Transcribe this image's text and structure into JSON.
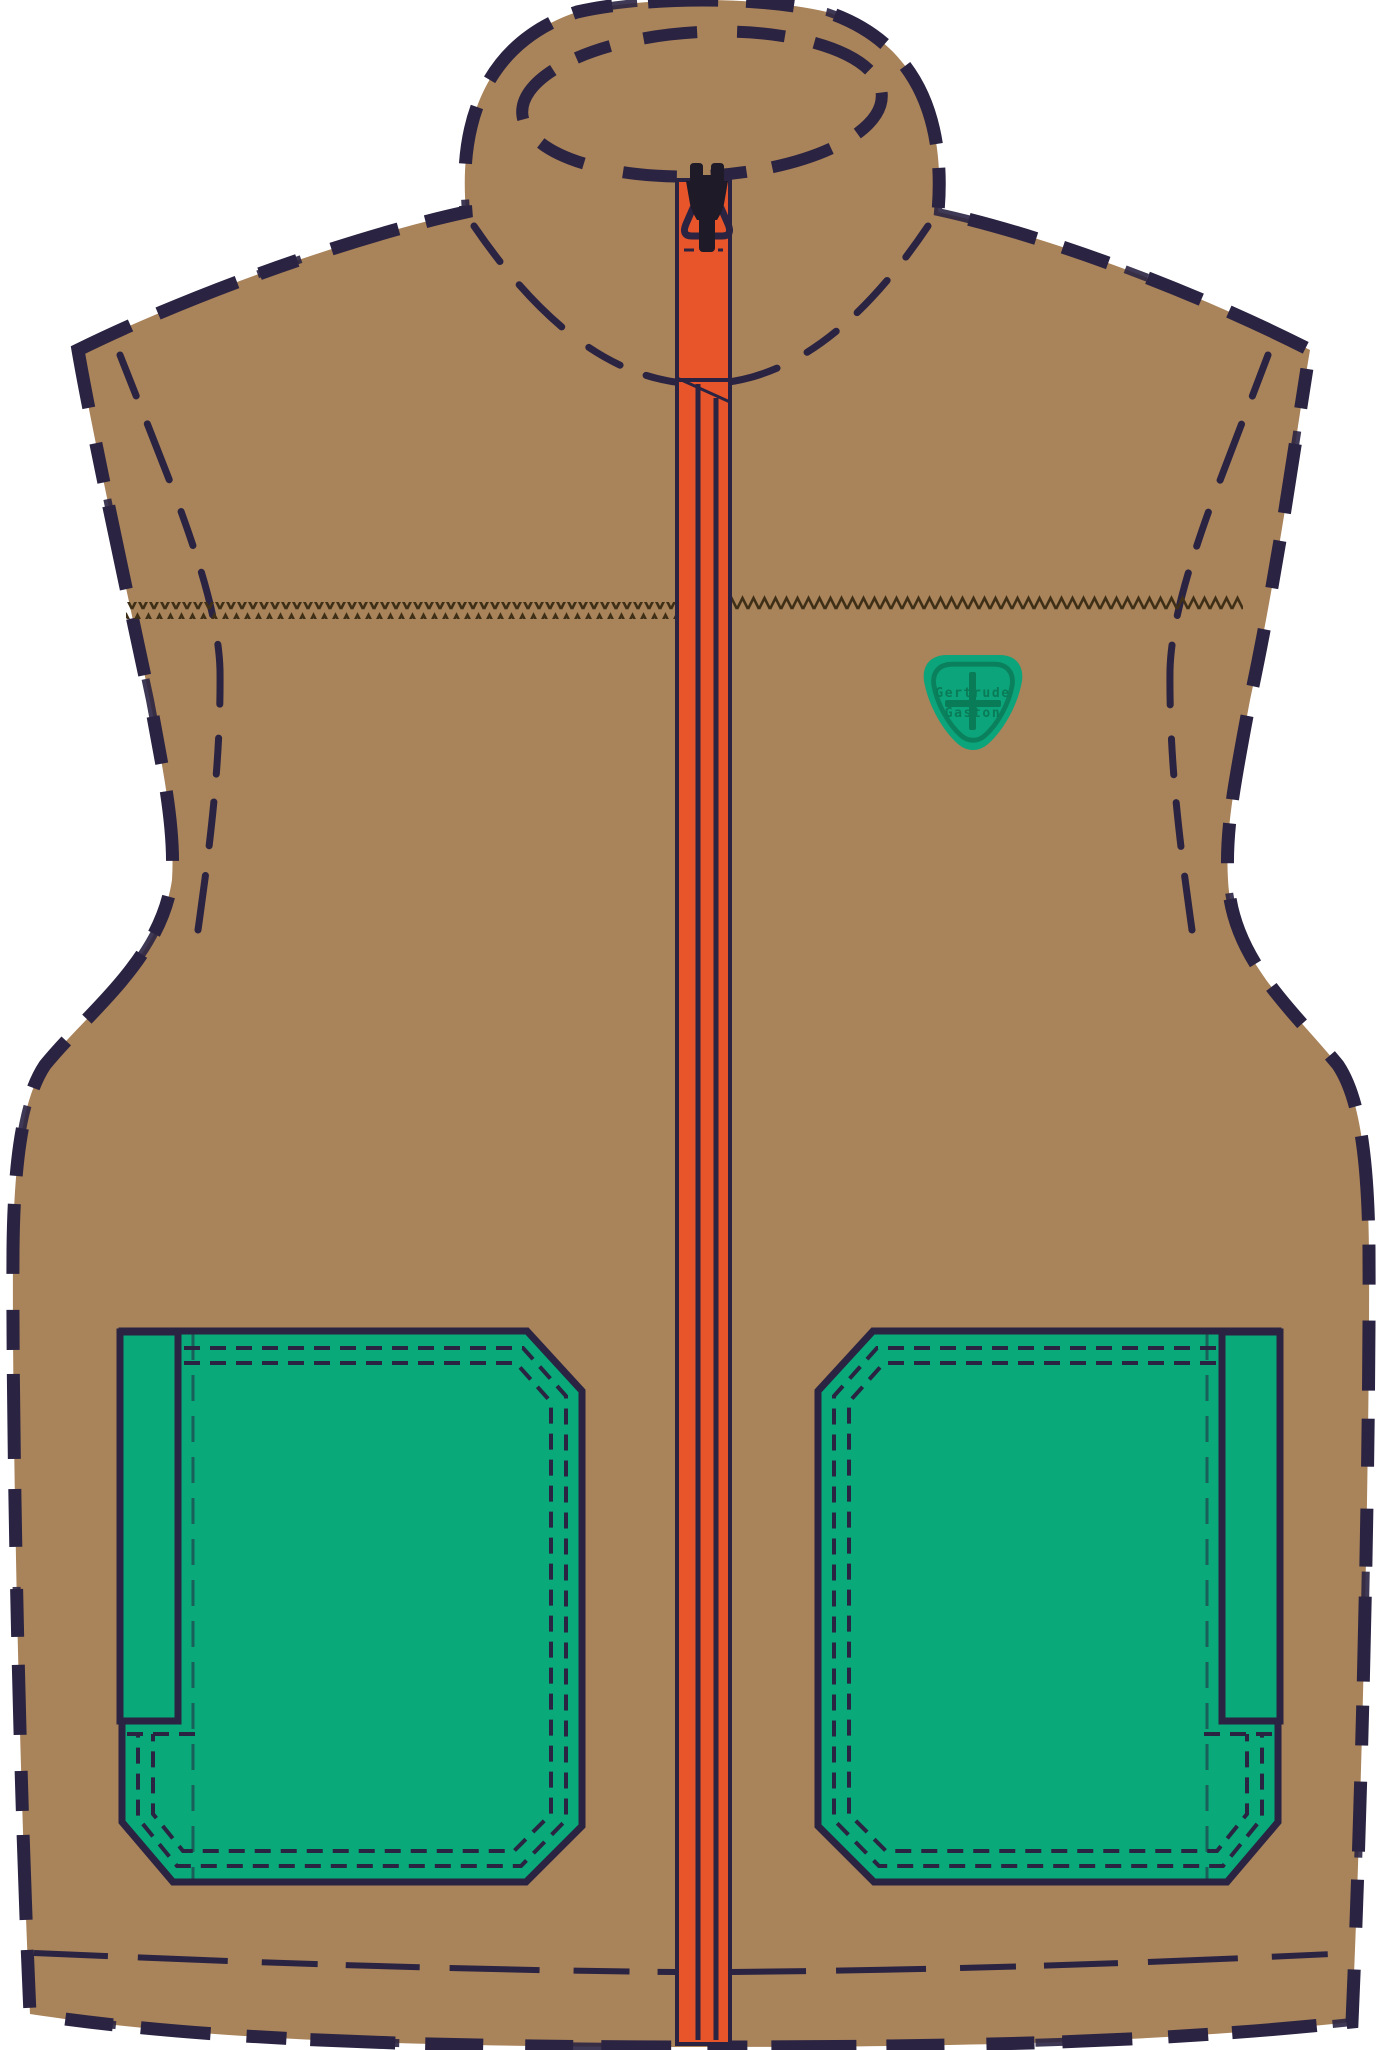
{
  "illustration": {
    "subject": "vest flat sketch",
    "badge": {
      "line1": "Gertrude",
      "line2": "Gaston"
    }
  },
  "colors": {
    "background": "#ffffff",
    "fleece_tan": "#a9835a",
    "outline_navy": "#2a2342",
    "zipper_orange": "#e8552b",
    "pocket_green": "#09a97a",
    "badge_green": "#0ca47a",
    "badge_dark_green": "#0a7b57",
    "slider_black": "#1e1a28",
    "topstitch_brown": "#3e2f16"
  }
}
